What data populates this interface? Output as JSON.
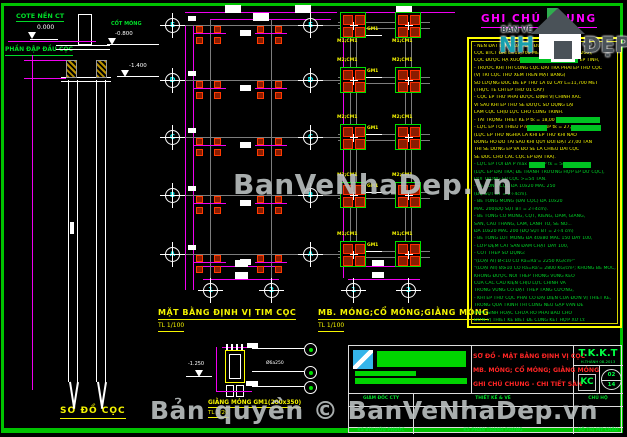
{
  "colors": {
    "frame": "#00c300",
    "dimension": "#ff00ff",
    "grid": "#7d7d7d",
    "pile_fill": "#8a1c00",
    "pile_edge": "#ff3a00",
    "footing_edge": "#00e000",
    "note_yellow": "#f5f500",
    "note_green": "#00d428",
    "title_red": "#ff2525"
  },
  "watermarks": {
    "center": "BanVeNhaDep.vn",
    "bottom": "Bản quyền © BanVeNhaDep.vn"
  },
  "logo": {
    "top": "BẢN VẼ",
    "main": "NH",
    "suffix": "ĐẸP"
  },
  "pile_elevation": {
    "title": "SƠ ĐỒ CỌC",
    "cote_label": "COTE NỀN CT",
    "cote_value": "0.000",
    "foundation_level_label": "CỐT MÓNG",
    "foundation_level_value": "-0.800",
    "crush_zone_label": "PHẦN ĐẬP ĐẦU CỌC",
    "pile_top_level": "-1.400"
  },
  "pile_plan": {
    "title": "MẶT BẰNG ĐỊNH VỊ TIM CỌC",
    "scale": "TL 1/100",
    "row_labels": [
      "E",
      "D",
      "C",
      "B",
      "A"
    ],
    "col_labels": [
      "1",
      "2"
    ]
  },
  "foundation_plan": {
    "title": "MB. MÓNG;CỔ MÓNG;GIẰNG MÓNG",
    "scale": "TL 1/100",
    "rows": [
      {
        "grid": "E",
        "left_footing": "M1;CM1",
        "right_footing": "M1;CM1",
        "beam": "GM1"
      },
      {
        "grid": "D",
        "left_footing": "M2;CM1",
        "right_footing": "M2;CM1",
        "beam": "GM1"
      },
      {
        "grid": "C",
        "left_footing": "M2;CM1",
        "right_footing": "M2;CM1",
        "beam": "GM1"
      },
      {
        "grid": "B",
        "left_footing": "M2;CM1",
        "right_footing": "M2;CM1",
        "beam": "GM1"
      },
      {
        "grid": "A",
        "left_footing": "M1;CM1",
        "right_footing": "M1;CM1",
        "beam": "GM1"
      }
    ]
  },
  "beam_detail": {
    "title": "GIẰNG MÓNG GM1(200x350)",
    "scale": "TL 1/20",
    "level": "-1.250",
    "stirrup": "Ø6a250"
  },
  "notes": {
    "title": "GHI CHÚ CHUNG",
    "lines": [
      {
        "text": "- NỀN ĐẤT DƯỚI ĐÁY ĐÀI ĐƯỢC GIA CỐ BẰNG",
        "color": "yellow"
      },
      {
        "text": "CỌC BTCT ĐÀI L=11,700 MÉT (TIẾT DIỆN 200x200),",
        "color": "yellow"
      },
      {
        "text": "CỌC ĐƯỢC HẠ XUỐNG BẰNG PHƯƠNG PHÁP ÉP TĨNH,",
        "color": "yellow"
      },
      {
        "text": "- TRƯỚC KHI THI CÔNG CỌC ĐẠI TRÀ PHẢI ÉP THỬ CỌC",
        "color": "yellow"
      },
      {
        "text": "(VỊ TRÍ CỌC THỬ XEM TRÊN MẶT BẰNG)",
        "color": "yellow"
      },
      {
        "text": "SỐ LƯỢNG ĐÚC ĐỂ ÉP THỬ LÀ 02 CÂY L=11,700 MÉT",
        "color": "yellow"
      },
      {
        "text": "(THỰC TẾ CHỈ ÉP THỬ 01 CÂY)",
        "color": "yellow"
      },
      {
        "text": "- CỌC ÉP THỬ PHẢI ĐƯỢC ĐỊNH VỊ CHÍNH XÁC",
        "color": "yellow"
      },
      {
        "text": "VÌ SAU KHI ÉP THỬ SẼ ĐƯỢC SỬ DỤNG LẠI",
        "color": "yellow"
      },
      {
        "text": "LÀM CỌC CHỊU LỰC CHO CÔNG TRÌNH.",
        "color": "yellow"
      },
      {
        "text": "- TẢI TRỌNG THIẾT KẾ P tk = 18,00 TẤN.",
        "color": "yellow"
      },
      {
        "text": "- LỰC ÉP TỐI THIỂU P min =1,5xP tk = 27,00 TẤN",
        "color": "yellow"
      },
      {
        "text": "(LỰC ÉP THỬ NGHĨA LÀ KHI ÉP THỬ KHI NÀO",
        "color": "yellow"
      },
      {
        "text": "ĐỒNG HỒ ĐO TẢI SAU KHI QUY ĐỔI ĐẠT 27,00 TẤN",
        "color": "yellow"
      },
      {
        "text": "THÌ SẼ DỪNG ÉP VÀ ĐÓ SẼ LÀ CHIỀU DÀI CỌC",
        "color": "yellow"
      },
      {
        "text": "SẼ ĐÚC CHO CÁC CỌC ÉP ĐẠI TRÀ).",
        "color": "yellow"
      },
      {
        "text": "- LỰC ÉP TỐI ĐA P max = 2,0xP tk = 54,00 TẤN",
        "color": "green"
      },
      {
        "text": "(LỰC ÉP ĐẠI TRÀ; ĐỂ TRÁNH TRƯỜNG HỢP ÉP DƯ CỌC),",
        "color": "green"
      },
      {
        "text": "ĐỐI TRỌNG ÉP CỌC >=54 TẤN.",
        "color": "green"
      },
      {
        "text": "- BÊ TÔNG CỌC ĐÁ 10x20 MÁC 250",
        "color": "green"
      },
      {
        "text": "(ĐỘ SỤT BT = 2÷4cm).",
        "color": "green"
      },
      {
        "text": "- BÊ TÔNG MÓNG (ĐÀI CỌC) ĐÁ 10x20",
        "color": "green"
      },
      {
        "text": "MÁC 200(ĐỘ SỤT BT = 2÷4cm).",
        "color": "green"
      },
      {
        "text": "- BÊ TÔNG CỔ MÓNG, CỘT, KIỀNG, DẦM, GIẰNG,",
        "color": "green"
      },
      {
        "text": "SÀN, CẦU THANG, LAM, LANH TÔ, SÊ NÔ...",
        "color": "green"
      },
      {
        "text": "ĐÁ 10x20 MÁC 200 (ĐỘ SỤT BT = 2÷4 cm)",
        "color": "green"
      },
      {
        "text": "- BÊ TÔNG LÓT MÓNG ĐÁ 40x80 MÁC 150 DÀY 100,",
        "color": "green"
      },
      {
        "text": "- LỚP ĐỆM CÁT SAN ĐẦM CHẶT DÀY 100,",
        "color": "green"
      },
      {
        "text": "- CỐT THÉP SỬ DỤNG:",
        "color": "green"
      },
      {
        "text": "\"(LOẠI AI) Ø<10 CÓ Ra=Ra'= 2250 KG/cm²\"",
        "color": "green"
      },
      {
        "text": "\"(LOẠI AII) Ø≥10 CÓ Ra=Ra'= 2800 KG/cm²; KHÔNG BẺ MÓC,",
        "color": "green"
      },
      {
        "text": "KHÔNG ĐƯỢC NỐI THÉP TRONG VÙNG KÉO",
        "color": "green"
      },
      {
        "text": "CỦA CÁC CẤU KIỆN CHỊU LỰC CHÍNH VÀ",
        "color": "green"
      },
      {
        "text": "TRONG VÙNG CÓ ĐẶT THÉP TĂNG CƯỜNG,",
        "color": "green"
      },
      {
        "text": "- KHI ÉP THỬ CỌC PHẢI CÓ ĐẠI DIỆN CỦA ĐƠN VỊ THIẾT KẾ,",
        "color": "green"
      },
      {
        "text": "TRONG QUÁ TRÌNH THI CÔNG NẾU GẶP VẤN ĐỀ",
        "color": "green"
      },
      {
        "text": "PHÁT SINH HOẶC CHƯA RÕ PHẢI BÁO CHO",
        "color": "green"
      },
      {
        "text": "ĐƠN VỊ THIẾT KẾ BIẾT ĐỂ CÙNG KẾT HỢP XỬ LÝ.",
        "color": "green"
      }
    ]
  },
  "title_block": {
    "stage": "T.K.K.T",
    "date": "H.THÀNH 08-2013",
    "discipline": "KC",
    "sheet_no": "02",
    "sheet_total": "14",
    "drawing_titles": [
      "SƠ ĐỒ - MẶT BẰNG ĐỊNH VỊ CỌC",
      "MB. MÓNG; CỔ MÓNG; GIẰNG MÓNG",
      "GHI CHÚ CHUNG - CHI TIẾT SÀN"
    ],
    "roles": [
      "GIÁM ĐỐC CTY",
      "THIẾT KẾ & VẼ",
      "CHỦ HỘ"
    ],
    "names": [
      "KS BÙI HỮU PHƯỚC",
      "KS PHAN THANH PHONG",
      "VÕ THỊ MỸ CHÂU"
    ]
  }
}
